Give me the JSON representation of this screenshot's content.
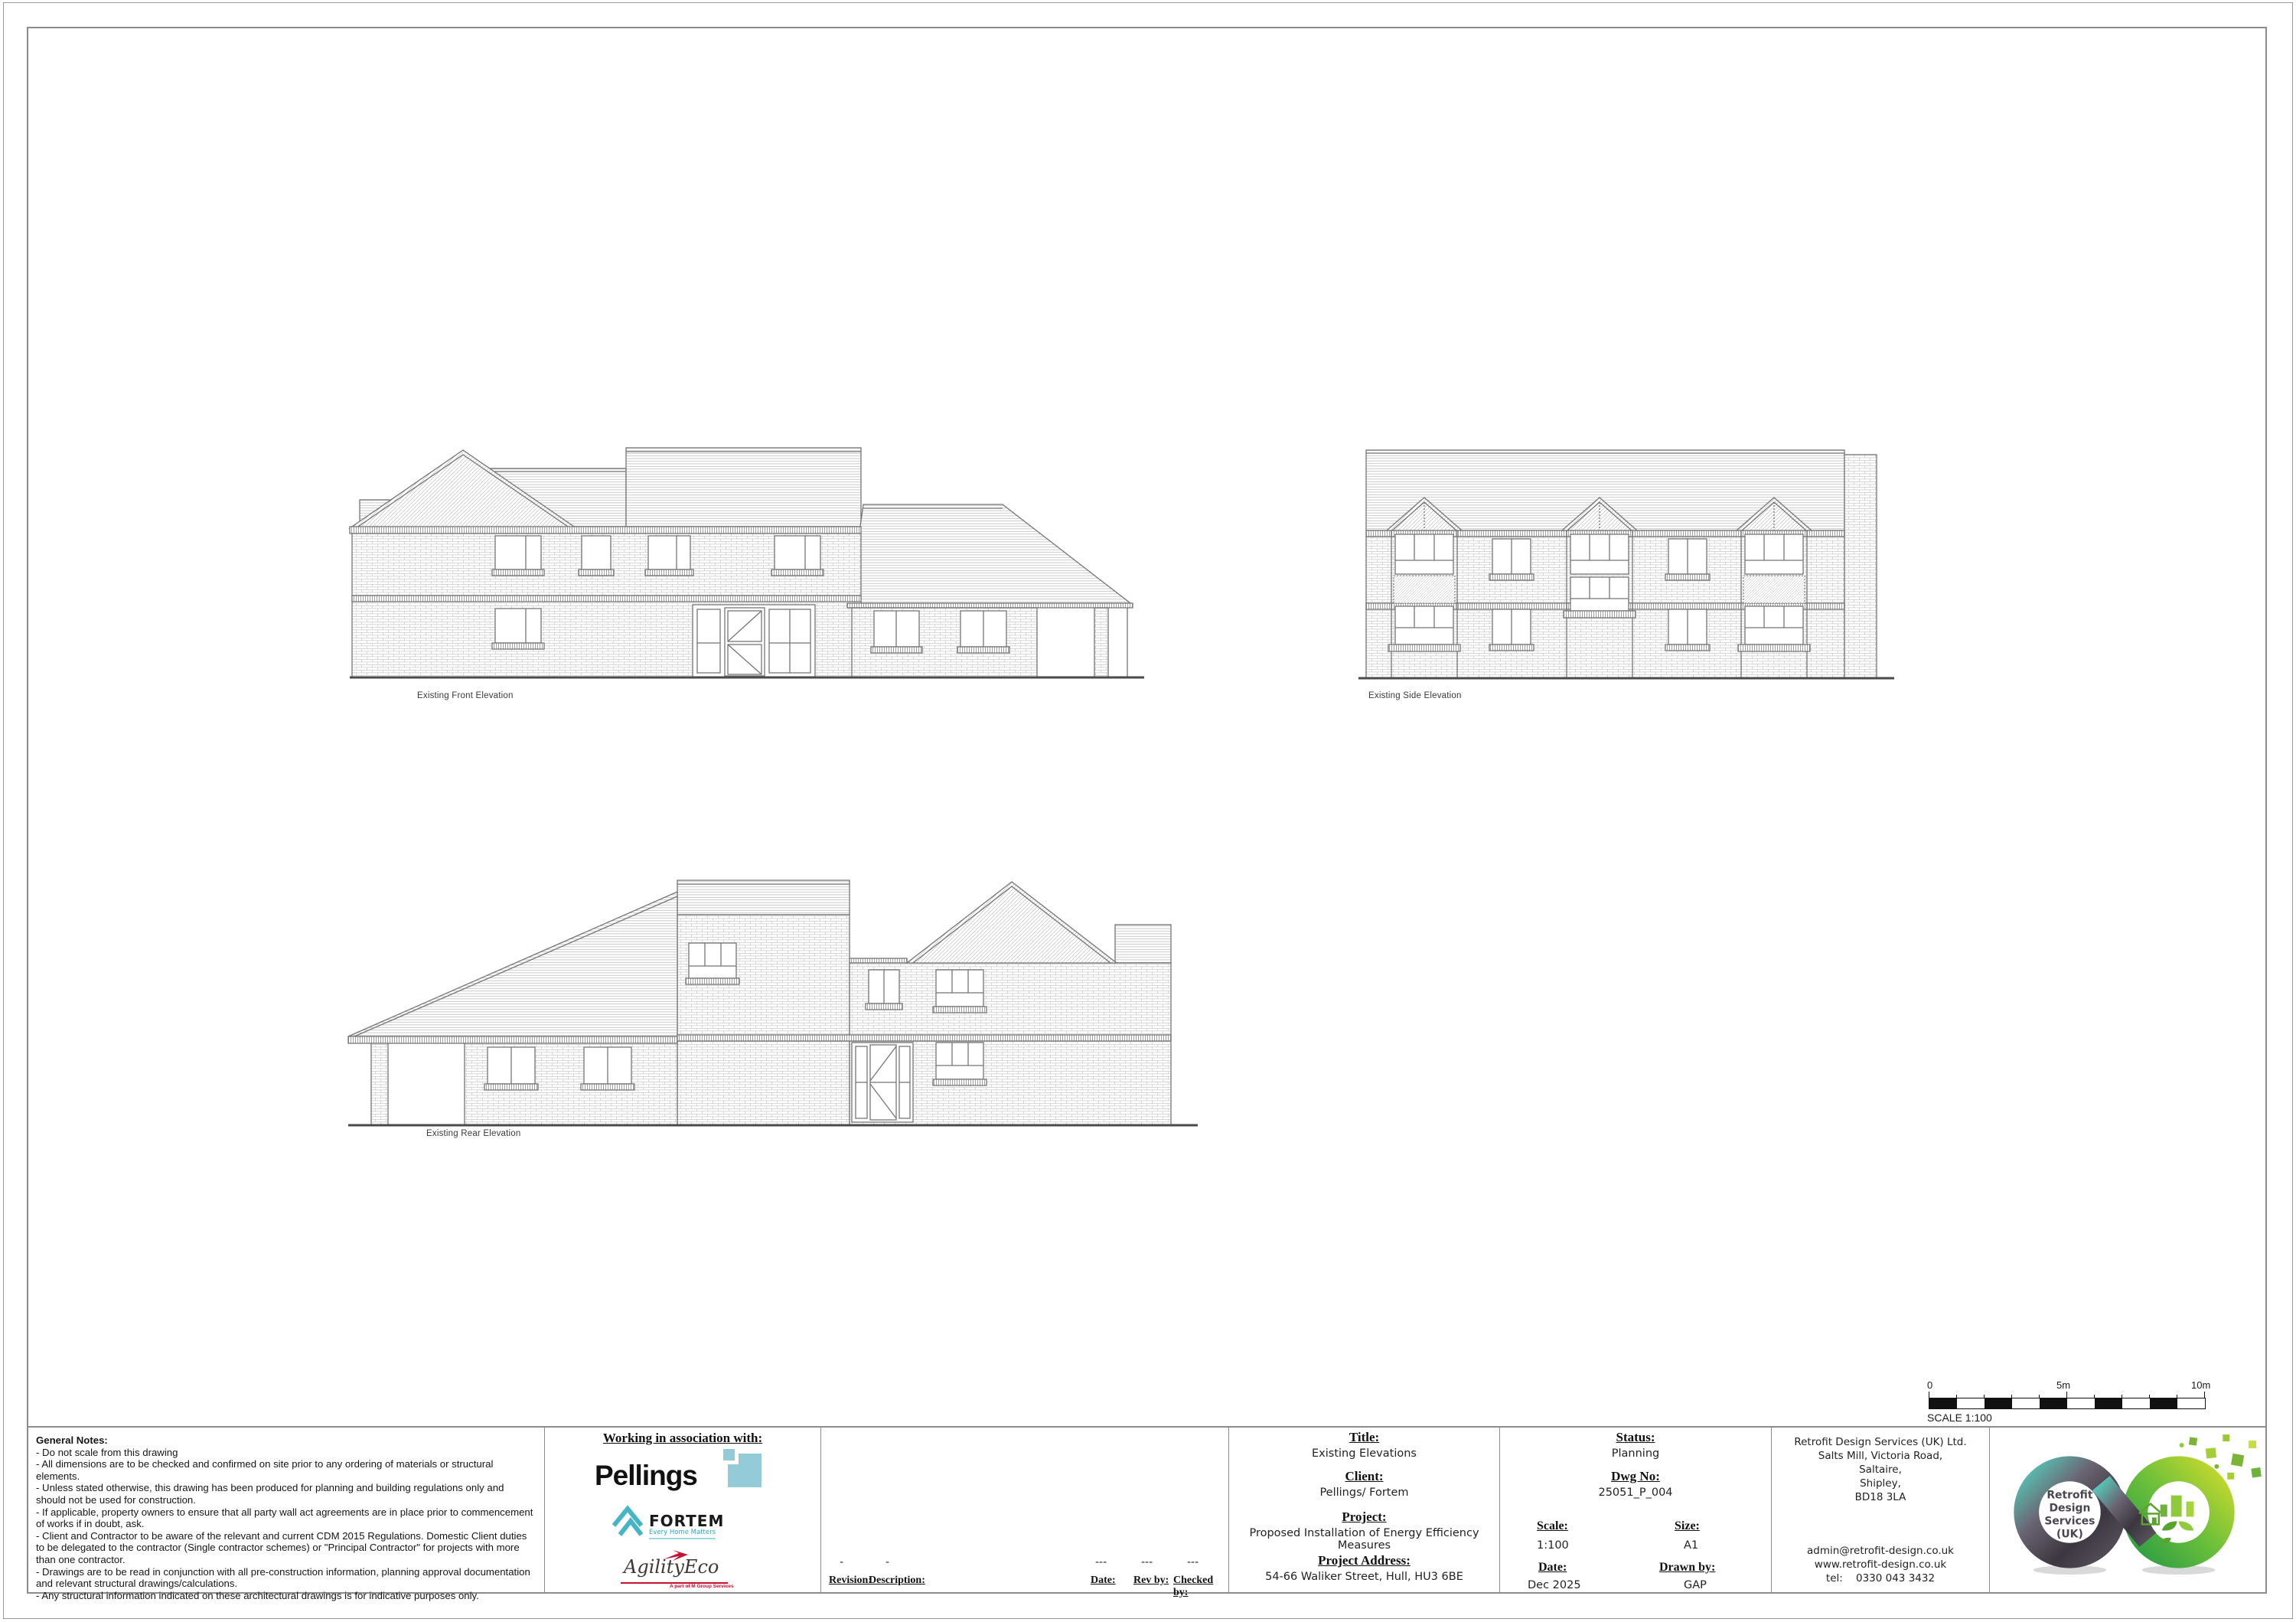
{
  "drawings": {
    "front_label": "Existing Front Elevation",
    "side_label": "Existing Side Elevation",
    "rear_label": "Existing Rear Elevation"
  },
  "scale_bar": {
    "zero": "0",
    "five": "5m",
    "ten": "10m",
    "caption": "SCALE 1:100"
  },
  "title_block": {
    "notes": {
      "heading": "General Notes:",
      "lines": [
        "- Do not scale from this drawing",
        "- All dimensions are to be checked and confirmed on site prior to any ordering of materials or structural elements.",
        "- Unless stated otherwise, this drawing has been produced for planning and building regulations only and should not be used for construction.",
        "- If applicable, property owners to ensure that all party wall act agreements are in place prior to commencement of works if in doubt, ask.",
        "- Client and Contractor to be aware of the relevant and current CDM 2015 Regulations. Domestic Client duties to be delegated to the contractor (Single contractor schemes) or \"Principal Contractor\" for projects with more than one contractor.",
        "- Drawings are to be read in conjunction with all pre-construction information, planning approval documentation and relevant structural drawings/calculations.",
        "- Any structural information indicated on these architectural drawings is for indicative purposes only."
      ]
    },
    "association": {
      "heading": "Working in association with:",
      "pellings": "Pellings",
      "fortem": "FORTEM",
      "fortem_tagline": "Every Home Matters",
      "agility": "AgilityEco",
      "agility_tagline": "A part of M Group Services"
    },
    "revision": {
      "labels": {
        "revision": "Revision:",
        "description": "Description:",
        "date": "Date:",
        "rev_by": "Rev by:",
        "checked_by": "Checked by:"
      },
      "values": {
        "revision": "-",
        "description": "-",
        "date": "---",
        "rev_by": "---",
        "checked_by": "---"
      }
    },
    "title": {
      "label": "Title:",
      "value": "Existing Elevations"
    },
    "client": {
      "label": "Client:",
      "value": "Pellings/ Fortem"
    },
    "project": {
      "label": "Project:",
      "value": "Proposed Installation of Energy Efficiency Measures"
    },
    "address": {
      "label": "Project Address:",
      "value": "54-66 Waliker Street, Hull, HU3 6BE"
    },
    "status": {
      "label": "Status:",
      "value": "Planning"
    },
    "dwg_no": {
      "label": "Dwg No:",
      "value": "25051_P_004"
    },
    "scale": {
      "label": "Scale:",
      "value": "1:100"
    },
    "size": {
      "label": "Size:",
      "value": "A1"
    },
    "date": {
      "label": "Date:",
      "value": "Dec 2025"
    },
    "drawn_by": {
      "label": "Drawn by:",
      "value": "GAP"
    },
    "company": {
      "name": "Retrofit Design Services (UK) Ltd.",
      "address_lines": [
        "Salts Mill, Victoria Road,",
        "Saltaire,",
        "Shipley,",
        "BD18 3LA"
      ],
      "email": "admin@retrofit-design.co.uk",
      "website": "www.retrofit-design.co.uk",
      "tel": "tel:    0330 043 3432"
    },
    "logo": {
      "line1": "Retrofit",
      "line2": "Design",
      "line3": "Services",
      "line4": "(UK)"
    }
  },
  "colors": {
    "pellings_blue": "#93ccd8",
    "fortem_teal": "#45b5c6",
    "agility_red": "#c41230",
    "logo_green": "#6cbf3a",
    "logo_grey": "#46414c"
  }
}
